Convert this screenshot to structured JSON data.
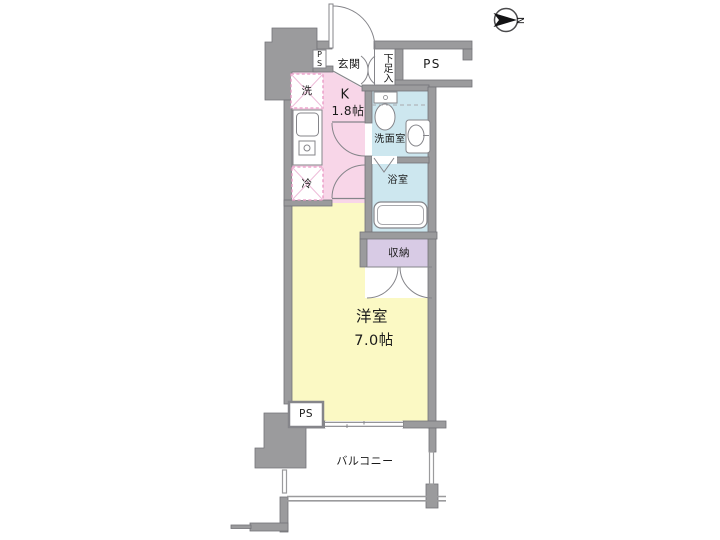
{
  "colors": {
    "wall": "#9b9b9d",
    "wall_edge": "#737378",
    "kitchen": "#f8d6e8",
    "main_room": "#fbf9c4",
    "wet_area": "#cde7ef",
    "closet": "#d8cbe5",
    "fixture_stroke": "#85858a",
    "fixture_inner": "#a9a9ad",
    "dashed_box_border": "#e896c4",
    "dashed_box_cross": "#eebcd9",
    "white": "#ffffff",
    "text": "#1a1a1a"
  },
  "compass": {
    "north_label": "N"
  },
  "labels": {
    "entrance": "玄関",
    "shoe_cabinet": "下足入",
    "pipe_space_top": "PS",
    "pipe_space_entrance": "PS",
    "washer": "洗",
    "kitchen_type": "K",
    "kitchen_size": "1.8帖",
    "fridge": "冷",
    "washroom": "洗面室",
    "bathroom": "浴室",
    "closet": "収納",
    "main_room_type": "洋室",
    "main_room_size": "7.0帖",
    "pipe_space_bottom": "PS",
    "balcony": "バルコニー"
  }
}
